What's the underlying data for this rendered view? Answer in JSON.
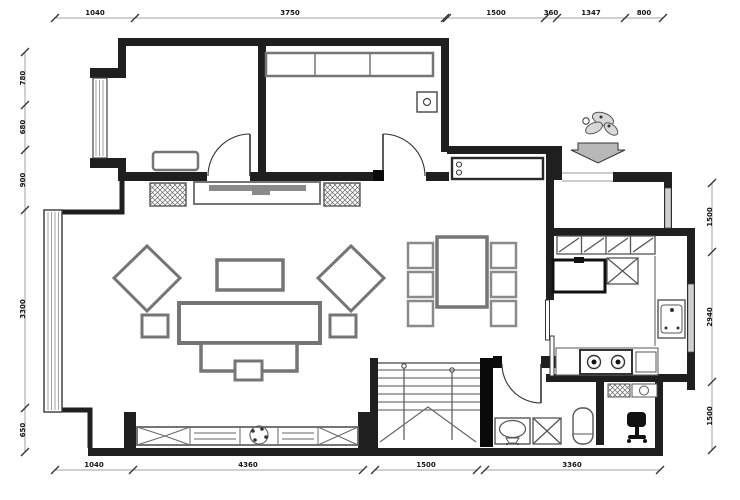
{
  "figure": {
    "type": "architectural-floor-plan",
    "style": "CAD black-line drawing on white"
  },
  "dimensions": {
    "top": [
      "1040",
      "3750",
      "1500",
      "360",
      "1347",
      "800"
    ],
    "bottom": [
      "1040",
      "4360",
      "1500",
      "3360"
    ],
    "left": [
      "780",
      "680",
      "900",
      "3300",
      "650"
    ],
    "right": [
      "1500",
      "2940",
      "1500"
    ]
  },
  "icons": {
    "entrance_marker": "decorative-flower-with-down-arrow (main entry direction)",
    "plant": "potted-plant",
    "office_chair": "desk-chair",
    "stair_direction": "v-break-lines"
  },
  "rooms": {
    "top_left": "bedroom with bay window and dresser",
    "top_middle": "bedroom with 3-door wardrobe and corner unit",
    "entry": "hall with shoe bench",
    "center": "living room with sofa group and TV wall",
    "dining": "dining table with six chairs",
    "kitchen": "kitchen with fridge, flue, sink, gas stove",
    "stairwell": "staircase with handrails",
    "bathroom": "bathroom with basin, shower box, toilet",
    "bottom_right": "small room with desk chair"
  },
  "colors": {
    "background": "#ffffff",
    "wall": "#1f1f1f",
    "wall_black": "#0a0a0a",
    "furniture": "#757575",
    "fixture": "#555555",
    "window": "#777777",
    "dim_line": "#a0a0a0",
    "dim_text": "#141414",
    "arrow_fill": "#b8b8b8"
  }
}
